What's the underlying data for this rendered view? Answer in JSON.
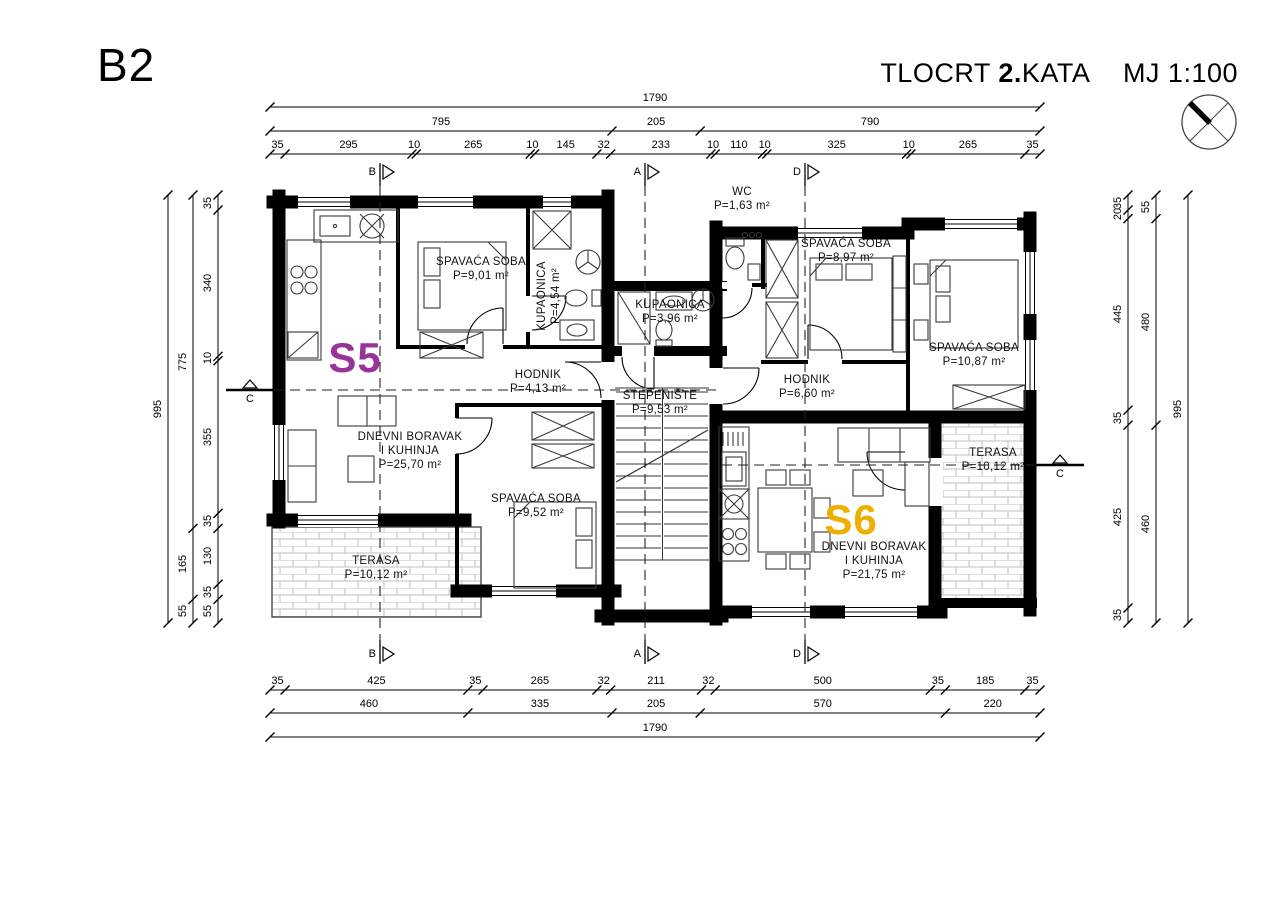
{
  "sheet": {
    "code": "B2",
    "title": {
      "prefix": "TLOCRT",
      "floor_bold": "2.",
      "floor_rest": "KATA",
      "scale": "MJ 1:100"
    }
  },
  "sections": {
    "top": [
      "B",
      "A",
      "D"
    ],
    "bottom": [
      "B",
      "A",
      "D"
    ],
    "left": "C",
    "right": "C"
  },
  "dims": {
    "top": {
      "total": [
        1790
      ],
      "groups": [
        795,
        205,
        790
      ],
      "segments": [
        35,
        295,
        10,
        265,
        10,
        145,
        32,
        233,
        10,
        110,
        10,
        325,
        10,
        265,
        35
      ]
    },
    "bottom": {
      "total": [
        1790
      ],
      "groups": [
        460,
        335,
        205,
        570,
        220
      ],
      "segments": [
        35,
        425,
        35,
        265,
        32,
        211,
        32,
        500,
        35,
        185,
        35
      ]
    },
    "left": {
      "total": [
        995
      ],
      "groups": [
        775,
        165,
        55
      ],
      "segments": [
        35,
        340,
        10,
        355,
        35,
        130,
        35,
        55
      ]
    },
    "right": {
      "total": [
        995
      ],
      "groups": [
        55,
        480,
        460
      ],
      "segments": [
        35,
        20,
        445,
        35,
        425,
        35
      ]
    }
  },
  "apartments": [
    {
      "id": "S5",
      "color": "#993399"
    },
    {
      "id": "S6",
      "color": "#efaf00"
    }
  ],
  "rooms": [
    {
      "name": "SPAVAĆA SOBA",
      "area": "P=9,01 m²"
    },
    {
      "name": "KUPAONICA",
      "area": "P=4,54 m²"
    },
    {
      "name": "HODNIK",
      "area": "P=4,13 m²"
    },
    {
      "name": "DNEVNI BORAVAK",
      "name2": "I KUHINJA",
      "area": "P=25,70 m²"
    },
    {
      "name": "SPAVAĆA SOBA",
      "area": "P=9,52 m²"
    },
    {
      "name": "TERASA",
      "area": "P=10,12 m²"
    },
    {
      "name": "WC",
      "area": "P=1,63 m²"
    },
    {
      "name": "KUPAONICA",
      "area": "P=3,96 m²"
    },
    {
      "name": "STEPENIŠTE",
      "area": "P=9,53 m²"
    },
    {
      "name": "SPAVAĆA SOBA",
      "area": "P=8,97 m²"
    },
    {
      "name": "SPAVAĆA SOBA",
      "area": "P=10,87 m²"
    },
    {
      "name": "HODNIK",
      "area": "P=6,60 m²"
    },
    {
      "name": "DNEVNI BORAVAK",
      "name2": "I KUHINJA",
      "area": "P=21,75 m²"
    },
    {
      "name": "TERASA",
      "area": "P=10,12 m²"
    }
  ]
}
